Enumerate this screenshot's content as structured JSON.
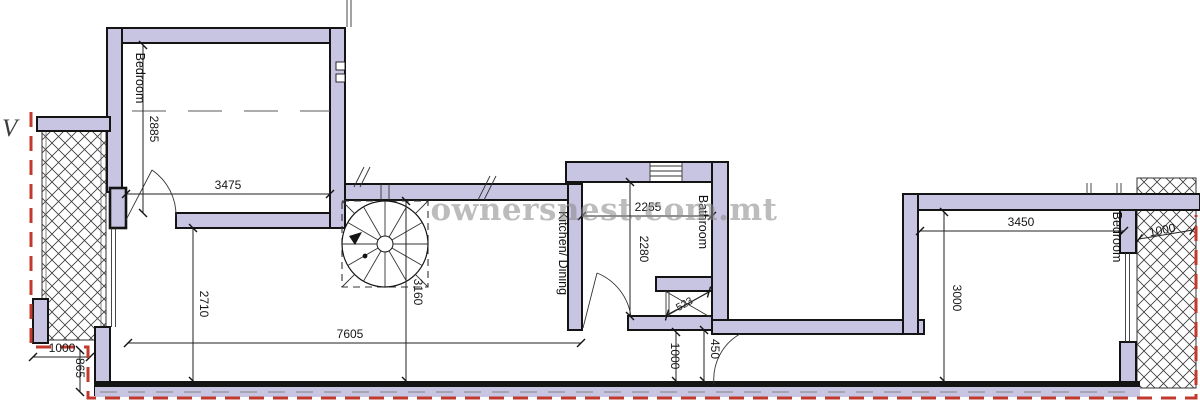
{
  "watermark": {
    "text": "ownersnest.com.mt"
  },
  "edge_label": "V",
  "rooms": {
    "bedroom_left": "Bedroom",
    "kitchen_dining": "Kitchen/ Dining",
    "bathroom": "Bathroom",
    "bedroom_right": "Bedroom"
  },
  "dims": {
    "d2885": "2885",
    "d3475": "3475",
    "d2710": "2710",
    "d7605": "7605",
    "d3160": "3160",
    "d2255": "2255",
    "d2280": "2280",
    "d523": "523",
    "d450": "450",
    "d1000_hall": "1000",
    "d3450": "3450",
    "d3000": "3000",
    "d1000_right": "1000",
    "d1000_left": "1000",
    "d865": "865"
  },
  "colors": {
    "wall_fill": "#c8c5e2",
    "wall_outline": "#141414",
    "boundary_red": "#c2392e",
    "watermark_gray": "#8c8c8c"
  }
}
